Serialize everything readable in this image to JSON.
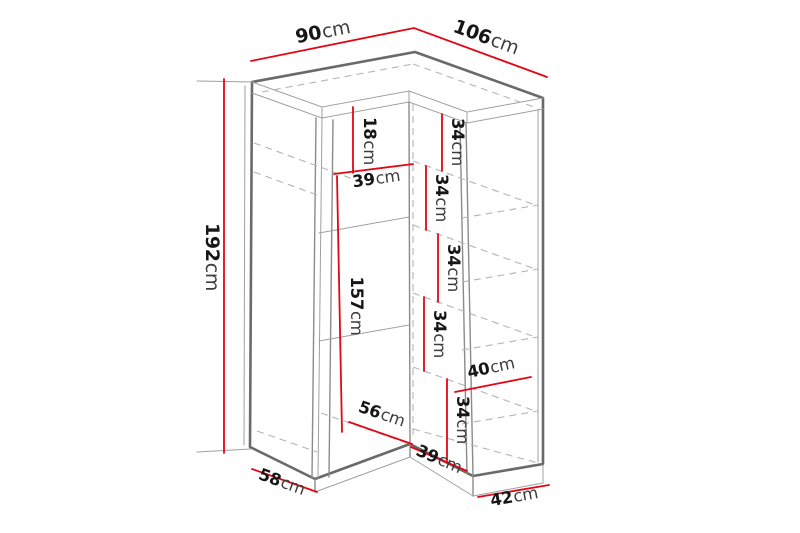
{
  "diagram": {
    "subject": "corner-wardrobe-dimension-diagram",
    "unit": "cm",
    "colors": {
      "dimension_line": "#e30613",
      "structure_line": "#6a6a6a",
      "hidden_line": "#b5b5b5",
      "label_text": "#161616",
      "background": "#ffffff"
    },
    "dims": {
      "top_width_left": {
        "value": "90",
        "unit": "cm"
      },
      "top_width_right": {
        "value": "106",
        "unit": "cm"
      },
      "height": {
        "value": "192",
        "unit": "cm"
      },
      "top_shelf_gap": {
        "value": "18",
        "unit": "cm"
      },
      "left_section_width": {
        "value": "39",
        "unit": "cm"
      },
      "left_section_height": {
        "value": "157",
        "unit": "cm"
      },
      "right_gap_1": {
        "value": "34",
        "unit": "cm"
      },
      "right_gap_2": {
        "value": "34",
        "unit": "cm"
      },
      "right_gap_3": {
        "value": "34",
        "unit": "cm"
      },
      "right_gap_4": {
        "value": "34",
        "unit": "cm"
      },
      "right_gap_5": {
        "value": "34",
        "unit": "cm"
      },
      "right_shelf_depth": {
        "value": "40",
        "unit": "cm"
      },
      "bottom_inner_left": {
        "value": "56",
        "unit": "cm"
      },
      "bottom_inner_right": {
        "value": "39",
        "unit": "cm"
      },
      "base_depth_left": {
        "value": "58",
        "unit": "cm"
      },
      "base_depth_right": {
        "value": "42",
        "unit": "cm"
      }
    }
  }
}
